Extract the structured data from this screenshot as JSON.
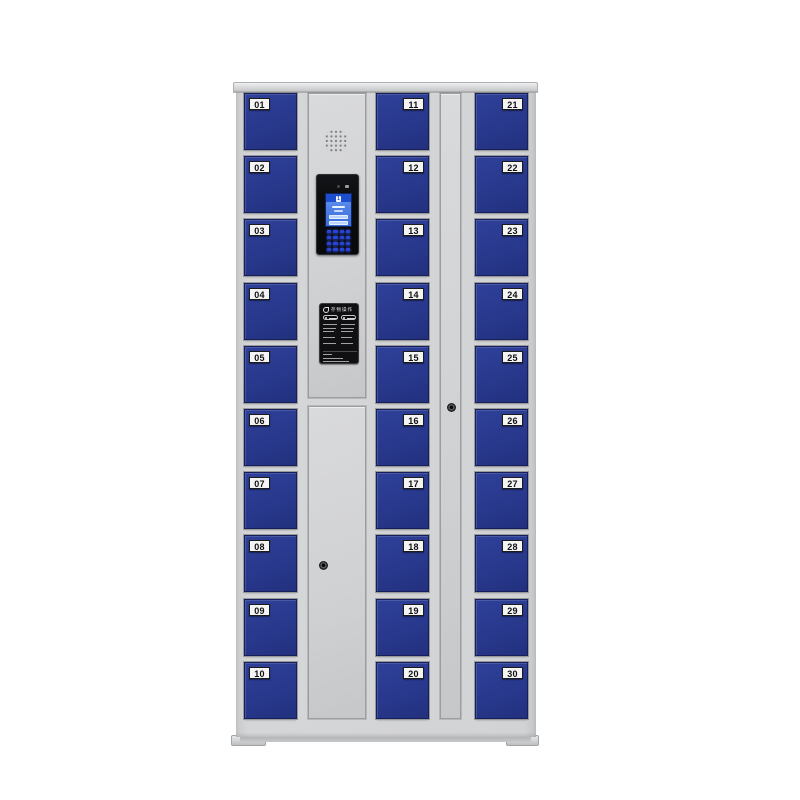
{
  "cabinet": {
    "type": "smart-storage-locker",
    "columns": [
      {
        "name": "left",
        "label_side": "left",
        "lockers": [
          "01",
          "02",
          "03",
          "04",
          "05",
          "06",
          "07",
          "08",
          "09",
          "10"
        ]
      },
      {
        "name": "middle",
        "label_side": "right",
        "lockers": [
          "11",
          "12",
          "13",
          "14",
          "15",
          "16",
          "17",
          "18",
          "19",
          "20"
        ]
      },
      {
        "name": "right",
        "label_side": "right",
        "lockers": [
          "21",
          "22",
          "23",
          "24",
          "25",
          "26",
          "27",
          "28",
          "29",
          "30"
        ]
      }
    ],
    "control_panel": {
      "speaker": "speaker-grille",
      "camera": "camera-and-sensor-dots",
      "screen": {
        "badge": "1"
      },
      "keypad": {
        "rows": 4,
        "cols": 4
      },
      "instruction_label": {
        "title": "存物操作"
      },
      "keyholes": 2
    },
    "colors": {
      "frame_gray": "#d2d3d5",
      "door_blue": "#28388c",
      "screen_blue": "#4f82e8",
      "keypad_blue": "#2945d8",
      "panel_black": "#0c0d0f",
      "label_bg": "#f4f4f4"
    }
  }
}
